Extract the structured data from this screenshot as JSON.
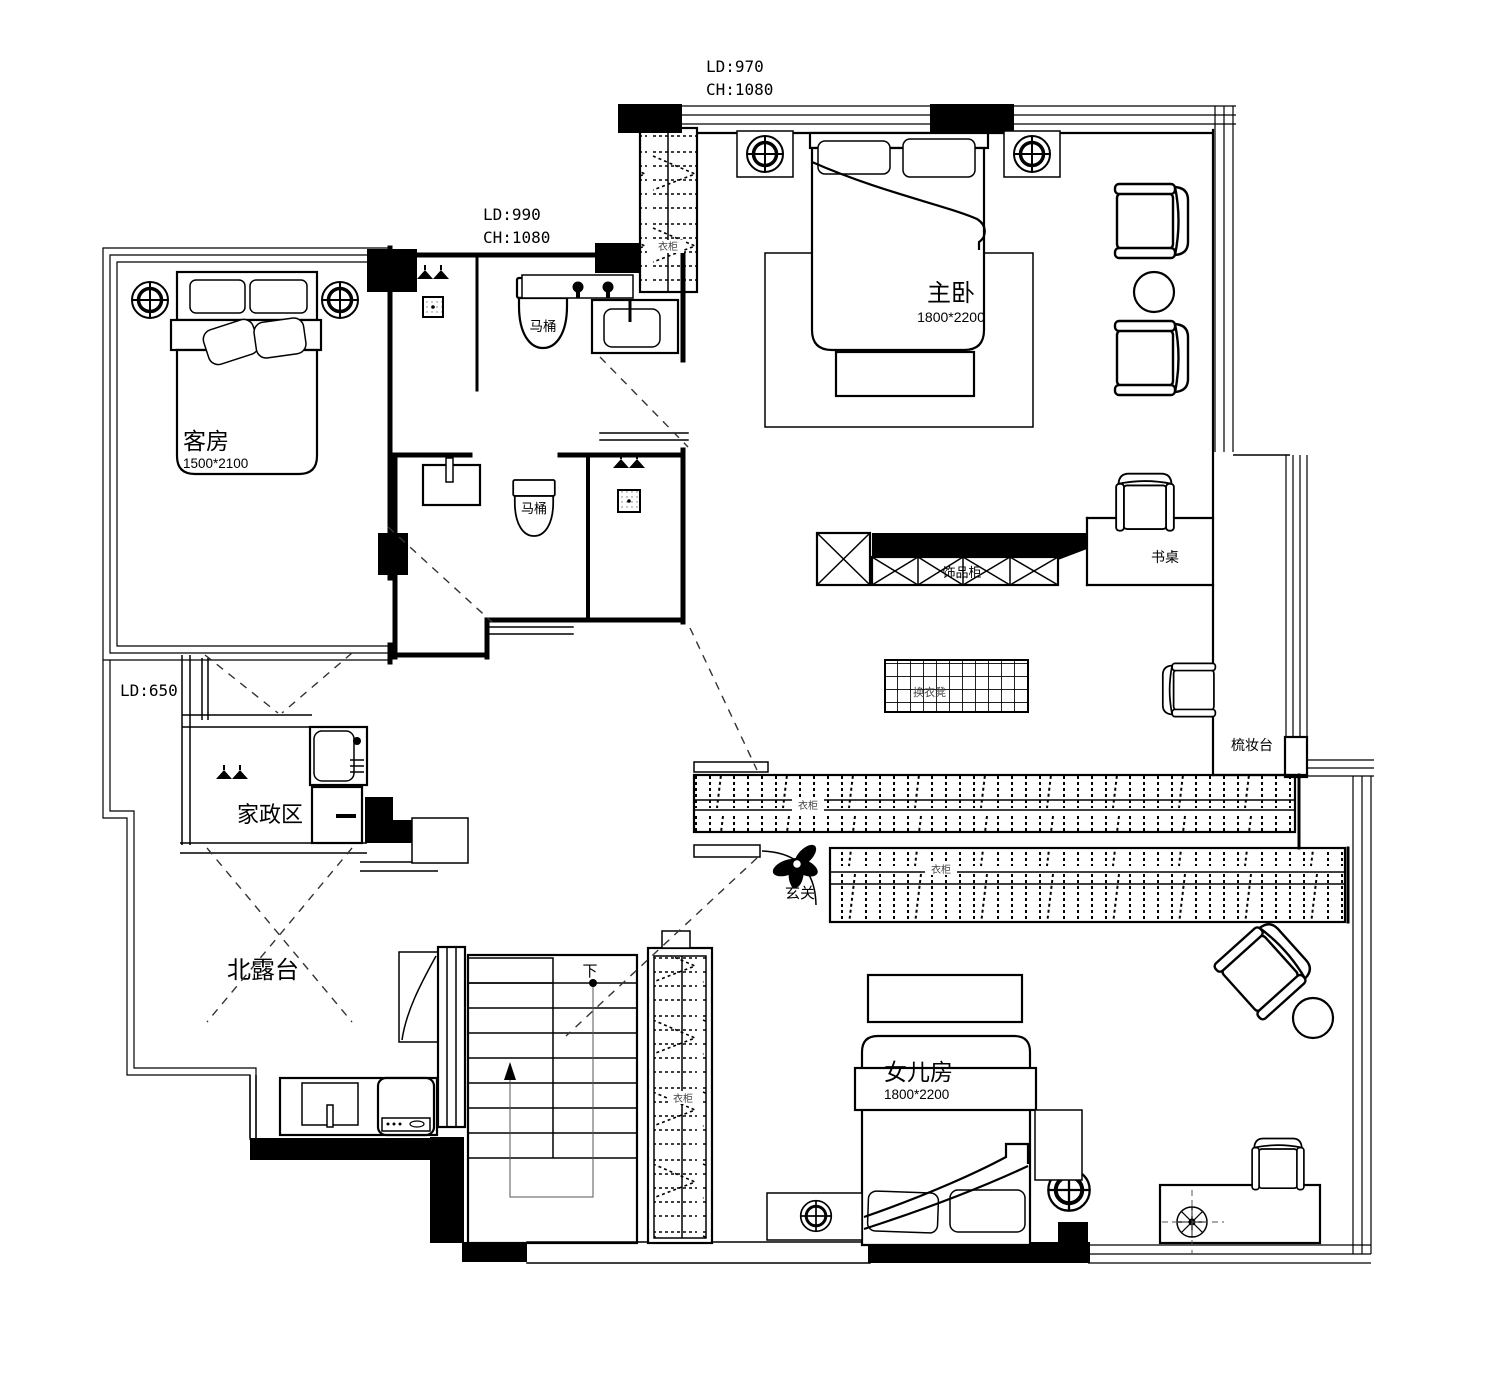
{
  "dimensions": {
    "top": {
      "ld": "LD:970",
      "ch": "CH:1080"
    },
    "mid": {
      "ld": "LD:990",
      "ch": "CH:1080"
    },
    "left": {
      "ld": "LD:650"
    }
  },
  "rooms": {
    "master": {
      "name": "主卧",
      "size": "1800*2200"
    },
    "guest": {
      "name": "客房",
      "size": "1500*2100"
    },
    "daughter": {
      "name": "女儿房",
      "size": "1800*2200"
    },
    "housekeeping": {
      "name": "家政区"
    },
    "terrace": {
      "name": "北露台"
    },
    "foyer": {
      "name": "玄关"
    }
  },
  "fixtures": {
    "toilet_upper": "马桶",
    "toilet_lower": "马桶",
    "wardrobe_strip": "衣柜",
    "wardrobe_hall_upper": "衣柜",
    "wardrobe_hall_lower": "衣柜",
    "wardrobe_stairs": "衣柜",
    "accessory_cabinet": "饰品柜",
    "desk": "书桌",
    "vanity": "梳妆台",
    "changing_bench": "换衣凳",
    "stairs_down": "下"
  },
  "colors": {
    "line": "#000000",
    "bg": "#ffffff",
    "dash": "#333333"
  }
}
